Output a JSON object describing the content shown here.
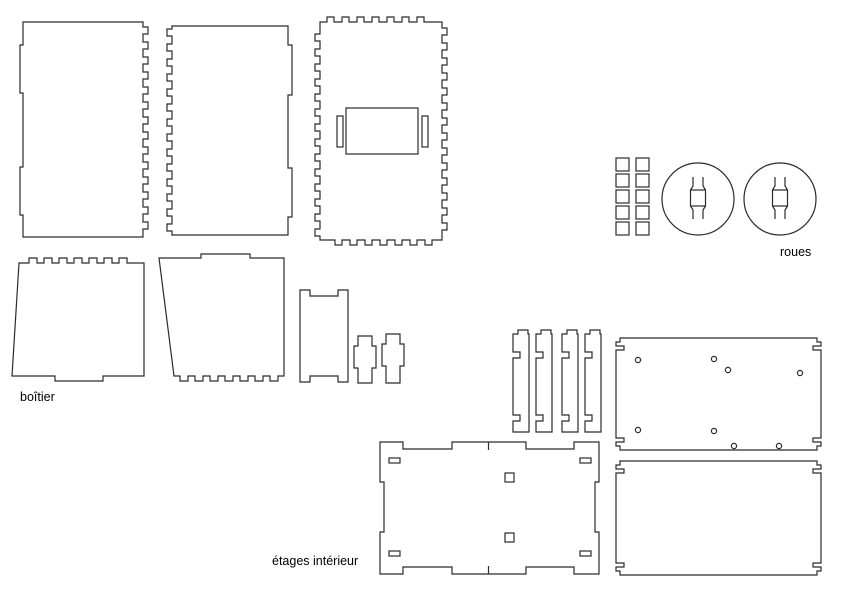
{
  "document": {
    "type": "laser-cut-parts-plan",
    "background_color": "#ffffff",
    "line_color": "#2b2b2b"
  },
  "labels": {
    "boitier": "boîtier",
    "roues": "roues",
    "etages_interieur": "étages intérieur"
  },
  "parts": {
    "side_panel_left": "finger-jointed side panel",
    "side_panel_right": "finger-jointed side panel (mirrored)",
    "back_panel": "panel with finger joints on all edges and motor mount cutout",
    "box_panel_top": "panel with top finger tabs",
    "box_panel_bottom": "panel with bottom finger tabs",
    "small_panel": "small panel with corner ears",
    "bracket_1": "small tabbed bracket",
    "bracket_2": "small tabbed bracket",
    "spacer_squares_count": 10,
    "wheels_count": 2,
    "shelf_rails_count": 4,
    "shelf_plate_hole_count": 8
  }
}
